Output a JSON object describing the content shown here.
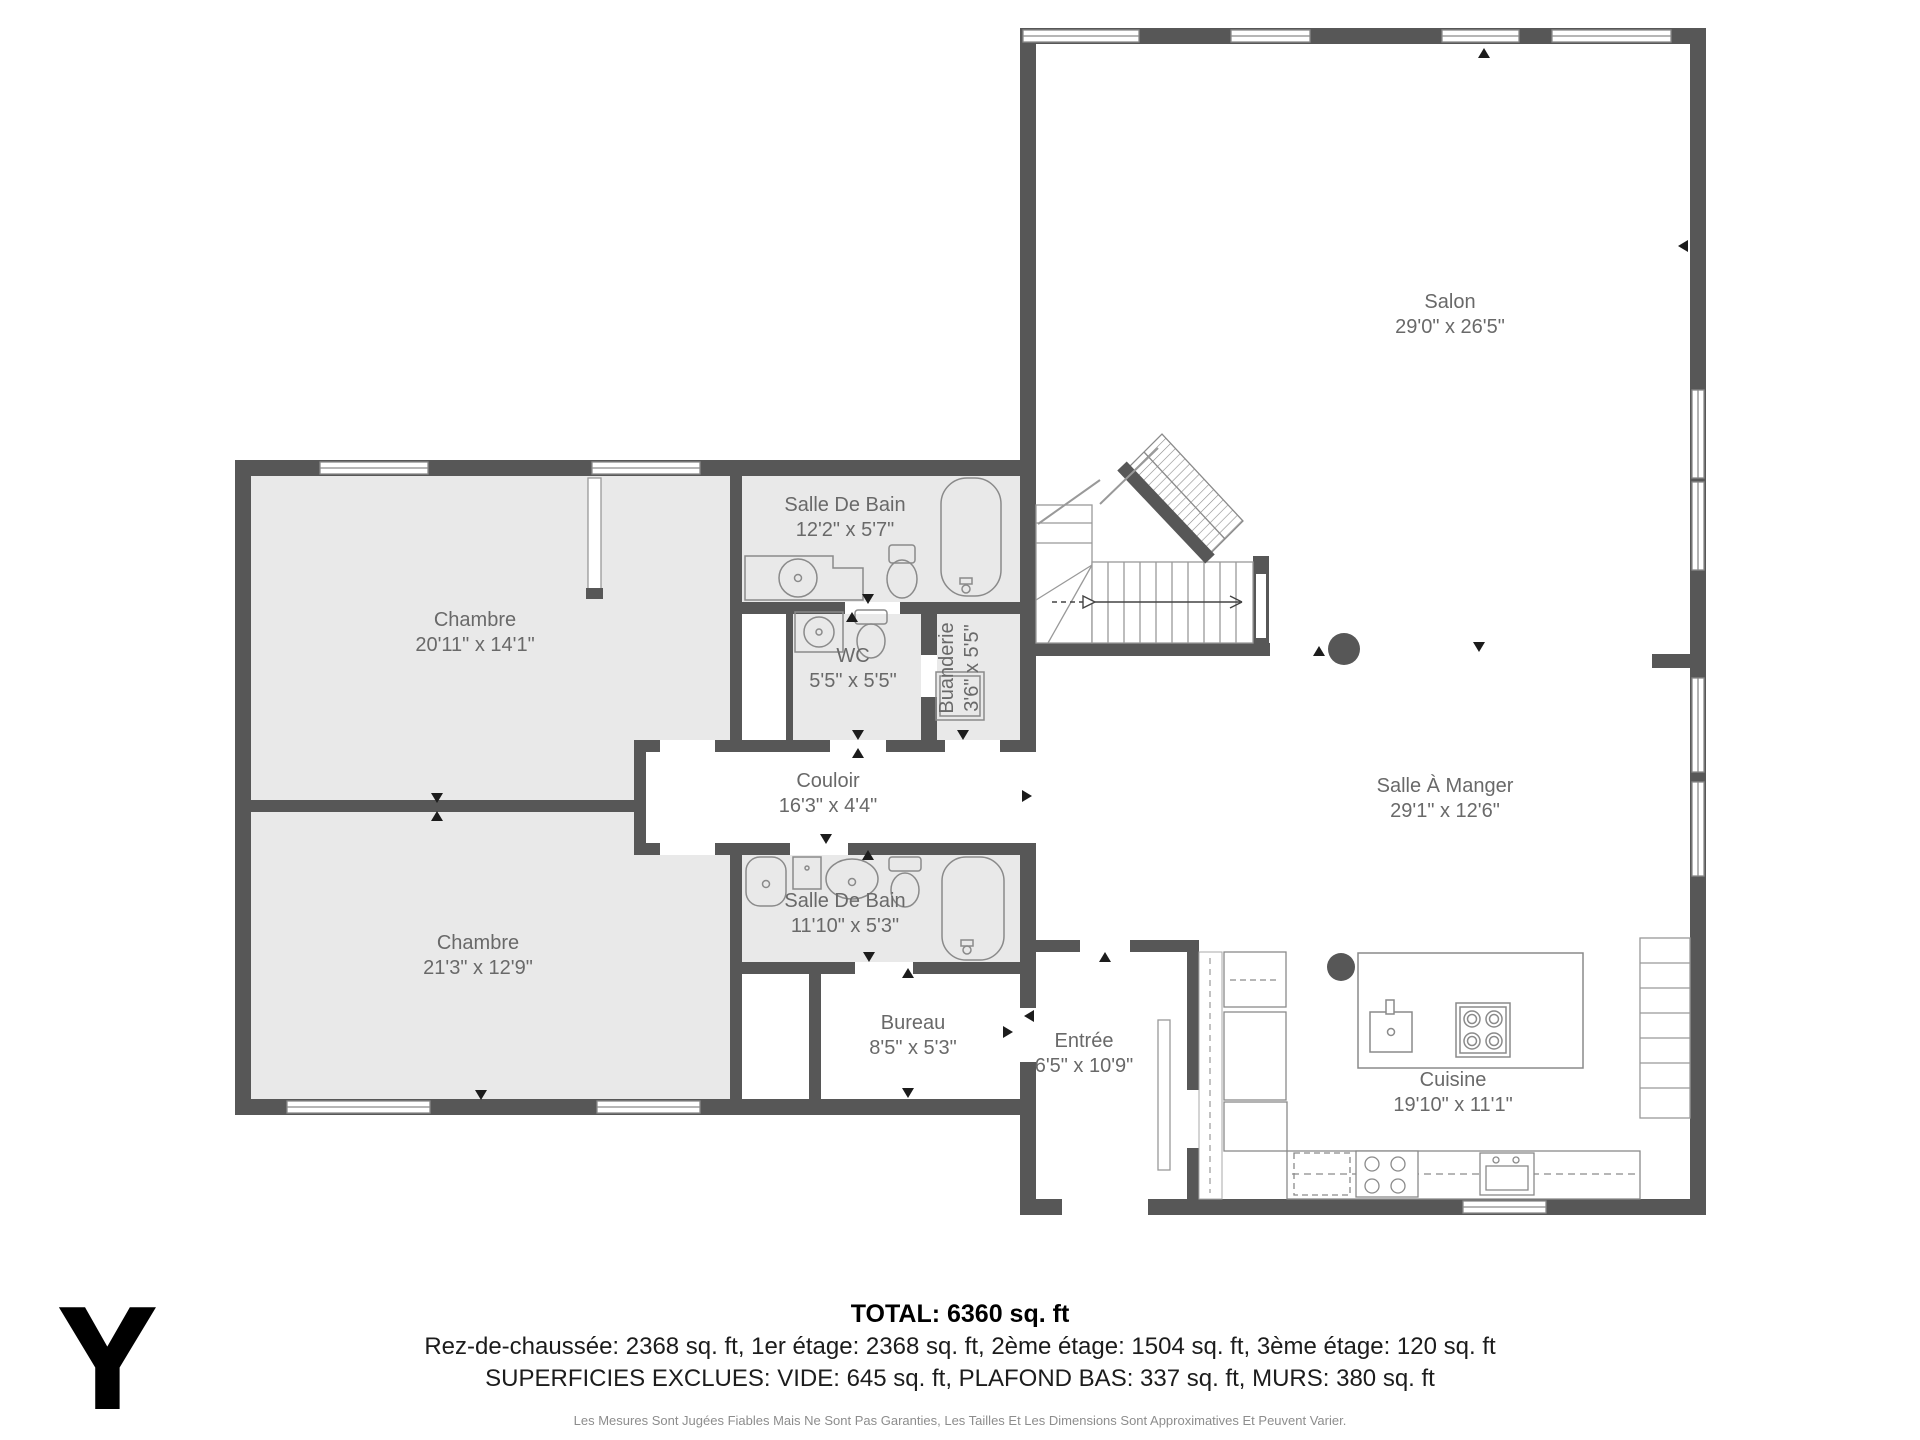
{
  "rooms": [
    {
      "name": "Salon",
      "dims": "29'0\" x 26'5\""
    },
    {
      "name": "Chambre",
      "dims": "20'11\" x 14'1\""
    },
    {
      "name": "Salle De Bain",
      "dims": "12'2\" x 5'7\""
    },
    {
      "name": "WC",
      "dims": "5'5\" x 5'5\""
    },
    {
      "name": "Buanderie",
      "dims": "3'6\" x 5'5\""
    },
    {
      "name": "Couloir",
      "dims": "16'3\" x 4'4\""
    },
    {
      "name": "Salle À Manger",
      "dims": "29'1\" x 12'6\""
    },
    {
      "name": "Salle De Bain",
      "dims": "11'10\" x 5'3\""
    },
    {
      "name": "Chambre",
      "dims": "21'3\" x 12'9\""
    },
    {
      "name": "Bureau",
      "dims": "8'5\" x 5'3\""
    },
    {
      "name": "Entrée",
      "dims": "6'5\" x 10'9\""
    },
    {
      "name": "Cuisine",
      "dims": "19'10\" x 11'1\""
    }
  ],
  "summary": {
    "total": "TOTAL: 6360 sq. ft",
    "floors": "Rez-de-chaussée: 2368 sq. ft, 1er étage: 2368 sq. ft, 2ème étage: 1504 sq. ft, 3ème étage: 120 sq. ft",
    "exclusions": "SUPERFICIES EXCLUES: VIDE: 645 sq. ft, PLAFOND BAS: 337 sq. ft, MURS: 380 sq. ft",
    "disclaimer": "Les Mesures Sont Jugées Fiables Mais Ne Sont Pas Garanties, Les Tailles Et Les Dimensions Sont Approximatives Et Peuvent Varier."
  },
  "logo": {
    "letter": "Y"
  },
  "colors": {
    "wall": "#575757",
    "room_fill": "#e9e9e9",
    "fixture_line": "#8a8a8a",
    "label": "#696969"
  }
}
